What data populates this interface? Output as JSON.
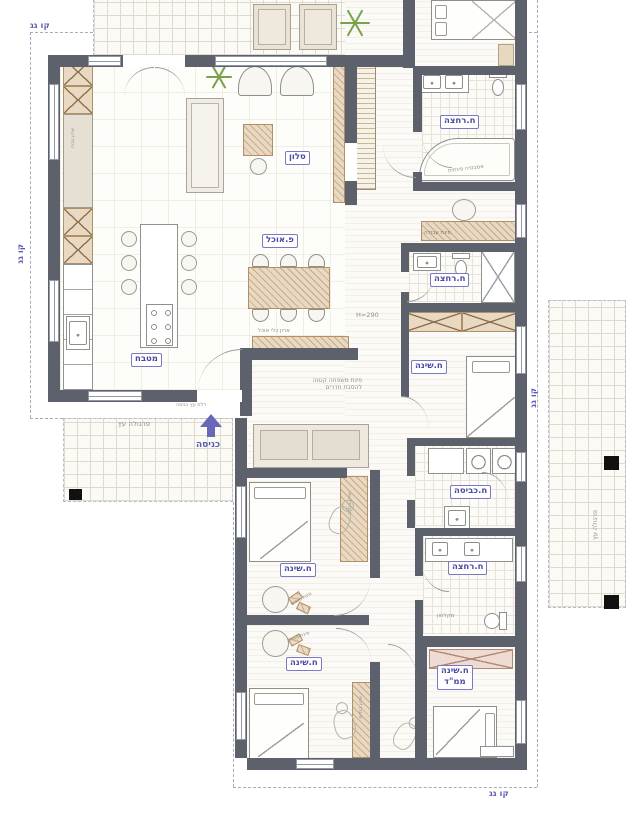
{
  "plan": {
    "title": "תכנית קומה",
    "rooms": {
      "living": "סלון",
      "dining": "פ.אוכל",
      "kitchen": "מטבח",
      "entrance": "כניסה",
      "bath_top": "ח.רחצה",
      "bath_mid": "ח.רחצה",
      "bath_bottom": "ח.רחצה",
      "bedroom_mid": "ח.שינה",
      "bedroom_1": "ח.שינה",
      "bedroom_2": "ח.שינה",
      "laundry": "ח.כביסה",
      "mamad_l1": "ח.שינה",
      "mamad_l2": "ממ\"ד"
    },
    "roof": {
      "top": "קו גג",
      "left": "קו גג",
      "right": "קו גג",
      "bottom": "קו גג"
    },
    "notes": {
      "pergola_entrance": "פרגולה עץ",
      "pergola_right": "פרגולה עץ",
      "entry_door": "דלת עץ כניסה",
      "corner_bath": "אמבטיה פינתית",
      "work_corner": "פינת עבודה",
      "family_line1": "פינת משפחה קטנה",
      "family_line2": "להסבת חדרים",
      "dish_cabinet": "ארון כלי אוכל",
      "ceiling_height": "H=290",
      "tv": "TV",
      "shower_stall": "מקלחון",
      "pouf_corner_1": "פינת פופים",
      "pouf_corner_2": "פינת פופים",
      "tall_cabinet": "ארון גבוה",
      "closet_1": "ארון בגדים",
      "closet_2": "ארון בגדים"
    },
    "colors": {
      "wall": "#5d616c",
      "label_blue": "#4a4aa8",
      "roof_blue": "#5c5cb4",
      "note_gray": "#8f8f88",
      "wood": "#ead9c2",
      "wood_line": "#b09068",
      "mamad_wood": "#eedcd2",
      "accent_green": "#79a24c"
    }
  }
}
